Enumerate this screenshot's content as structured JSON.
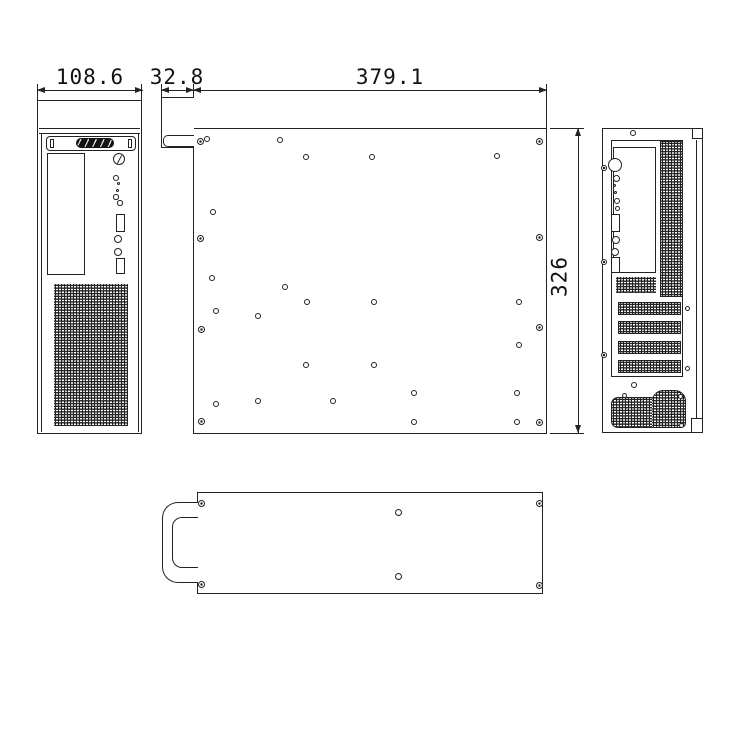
{
  "drawing": {
    "background": "#ffffff",
    "line_color": "#222222",
    "dims": {
      "front_width": "108.6",
      "handle_depth": "32.8",
      "body_length": "379.1",
      "body_height": "326"
    },
    "views": {
      "side": {
        "holes": [
          {
            "x": 200,
            "y": 141,
            "t": "screw",
            "d": 7
          },
          {
            "x": 207,
            "y": 139,
            "t": "ring",
            "d": 6
          },
          {
            "x": 280,
            "y": 140,
            "t": "ring",
            "d": 6
          },
          {
            "x": 306,
            "y": 157,
            "t": "ring",
            "d": 6
          },
          {
            "x": 372,
            "y": 157,
            "t": "ring",
            "d": 6
          },
          {
            "x": 497,
            "y": 156,
            "t": "ring",
            "d": 6
          },
          {
            "x": 539,
            "y": 141,
            "t": "screw",
            "d": 7
          },
          {
            "x": 213,
            "y": 212,
            "t": "ring",
            "d": 6
          },
          {
            "x": 200,
            "y": 238,
            "t": "screw",
            "d": 7
          },
          {
            "x": 539,
            "y": 237,
            "t": "screw",
            "d": 7
          },
          {
            "x": 212,
            "y": 278,
            "t": "ring",
            "d": 6
          },
          {
            "x": 285,
            "y": 287,
            "t": "ring",
            "d": 6
          },
          {
            "x": 307,
            "y": 302,
            "t": "ring",
            "d": 6
          },
          {
            "x": 374,
            "y": 302,
            "t": "ring",
            "d": 6
          },
          {
            "x": 519,
            "y": 302,
            "t": "ring",
            "d": 6
          },
          {
            "x": 216,
            "y": 311,
            "t": "ring",
            "d": 6
          },
          {
            "x": 258,
            "y": 316,
            "t": "ring",
            "d": 6
          },
          {
            "x": 201,
            "y": 329,
            "t": "screw",
            "d": 7
          },
          {
            "x": 539,
            "y": 327,
            "t": "screw",
            "d": 7
          },
          {
            "x": 519,
            "y": 345,
            "t": "ring",
            "d": 6
          },
          {
            "x": 306,
            "y": 365,
            "t": "ring",
            "d": 6
          },
          {
            "x": 374,
            "y": 365,
            "t": "ring",
            "d": 6
          },
          {
            "x": 414,
            "y": 393,
            "t": "ring",
            "d": 6
          },
          {
            "x": 517,
            "y": 393,
            "t": "ring",
            "d": 6
          },
          {
            "x": 258,
            "y": 401,
            "t": "ring",
            "d": 6
          },
          {
            "x": 333,
            "y": 401,
            "t": "ring",
            "d": 6
          },
          {
            "x": 216,
            "y": 404,
            "t": "ring",
            "d": 6
          },
          {
            "x": 201,
            "y": 421,
            "t": "screw",
            "d": 7
          },
          {
            "x": 414,
            "y": 422,
            "t": "ring",
            "d": 6
          },
          {
            "x": 517,
            "y": 422,
            "t": "ring",
            "d": 6
          },
          {
            "x": 539,
            "y": 422,
            "t": "screw",
            "d": 7
          }
        ]
      },
      "rear": {
        "holes": [
          {
            "x": 633,
            "y": 133,
            "t": "ring",
            "d": 6
          },
          {
            "x": 604,
            "y": 168,
            "t": "screw",
            "d": 6
          },
          {
            "x": 604,
            "y": 262,
            "t": "screw",
            "d": 6
          },
          {
            "x": 604,
            "y": 355,
            "t": "screw",
            "d": 6
          },
          {
            "x": 687,
            "y": 308,
            "t": "ring",
            "d": 5
          },
          {
            "x": 687,
            "y": 368,
            "t": "ring",
            "d": 5
          },
          {
            "x": 634,
            "y": 385,
            "t": "ring",
            "d": 6
          },
          {
            "x": 624,
            "y": 395,
            "t": "ring",
            "d": 5
          },
          {
            "x": 680,
            "y": 396,
            "t": "ring",
            "d": 5
          },
          {
            "x": 681,
            "y": 425,
            "t": "ring",
            "d": 5
          }
        ]
      },
      "bottom": {
        "holes": [
          {
            "x": 201,
            "y": 503,
            "t": "screw",
            "d": 7
          },
          {
            "x": 539,
            "y": 503,
            "t": "screw",
            "d": 7
          },
          {
            "x": 201,
            "y": 584,
            "t": "screw",
            "d": 7
          },
          {
            "x": 539,
            "y": 585,
            "t": "screw",
            "d": 7
          },
          {
            "x": 398,
            "y": 512,
            "t": "ring",
            "d": 7
          },
          {
            "x": 398,
            "y": 576,
            "t": "ring",
            "d": 7
          }
        ]
      }
    }
  }
}
